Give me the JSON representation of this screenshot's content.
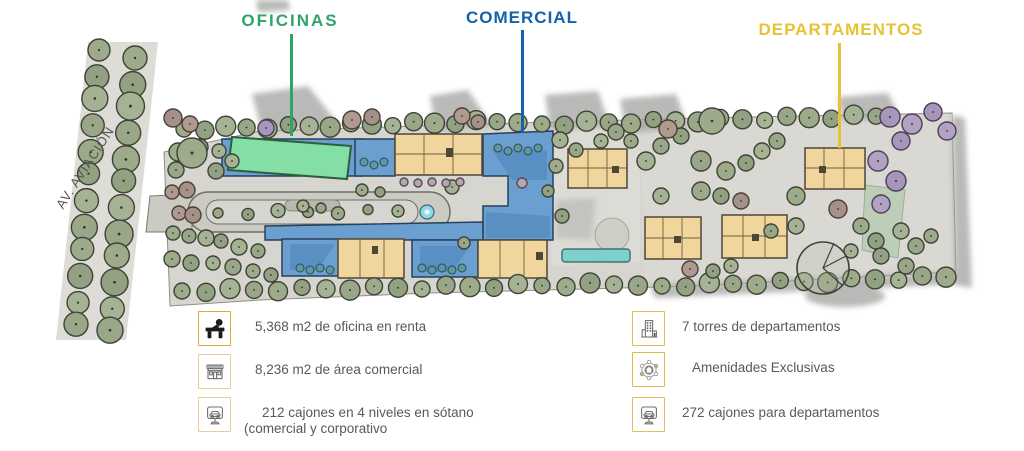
{
  "plan": {
    "street_label": "AV. AVIACIÓN",
    "zones": {
      "oficinas": {
        "label": "OFICINAS",
        "color": "#2ea46b"
      },
      "comercial": {
        "label": "COMERCIAL",
        "color": "#1263a9"
      },
      "departamentos": {
        "label": "DEPARTAMENTOS",
        "color": "#e8c235"
      }
    }
  },
  "facts": {
    "left": [
      {
        "icon": "office-desk-icon",
        "lines": [
          "5,368 m2 de oficina en renta"
        ]
      },
      {
        "icon": "storefront-icon",
        "lines": [
          "8,236 m2 de área comercial"
        ]
      },
      {
        "icon": "parking-sign-icon",
        "lines": [
          "212 cajones en 4 niveles en sótano",
          "(comercial y corporativo"
        ]
      }
    ],
    "right": [
      {
        "icon": "apartment-tower-icon",
        "lines": [
          "7 torres de departamentos"
        ]
      },
      {
        "icon": "amenities-icon",
        "lines": [
          "Amenidades Exclusivas"
        ]
      },
      {
        "icon": "parking-sign-icon",
        "lines": [
          "272 cajones para departamentos"
        ]
      }
    ]
  }
}
